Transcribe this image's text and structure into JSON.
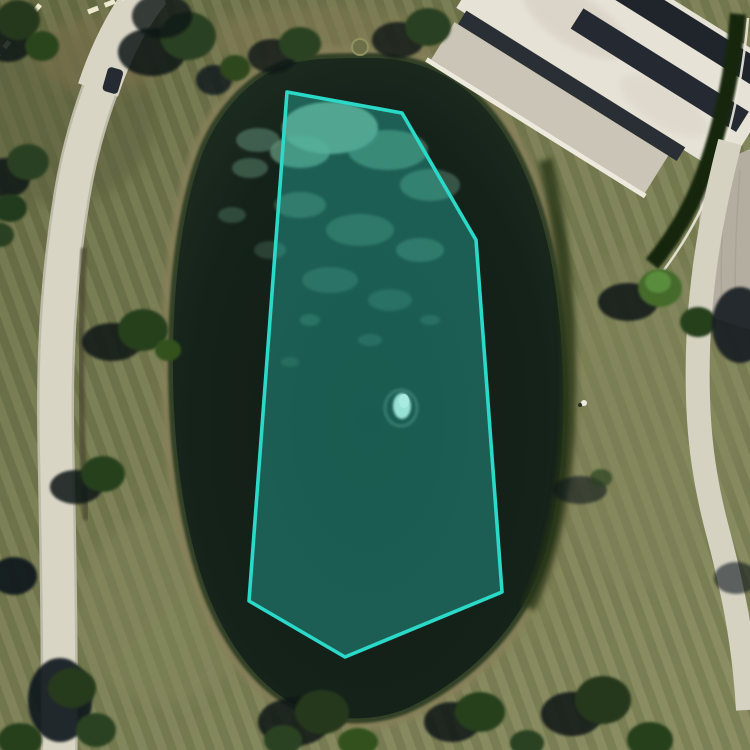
{
  "map": {
    "imagery_type": "aerial-satellite",
    "annotation": {
      "id": "water-body-polygon",
      "shape": "polygon",
      "stroke_color": "#2BD9C8",
      "fill_color": "rgba(46,214,199,0.34)",
      "stroke_width": 3.6,
      "vertices": [
        [
          287,
          92
        ],
        [
          402,
          113
        ],
        [
          476,
          240
        ],
        [
          502,
          592
        ],
        [
          345,
          657
        ],
        [
          249,
          601
        ]
      ]
    },
    "landmarks": {
      "water": "pond",
      "feature_in_water": "fountain",
      "structure": "flat-roof-building",
      "paths": [
        "west-walkway",
        "east-walkway",
        "southeast-path"
      ],
      "road_marking": "dashed-lane-line"
    }
  }
}
